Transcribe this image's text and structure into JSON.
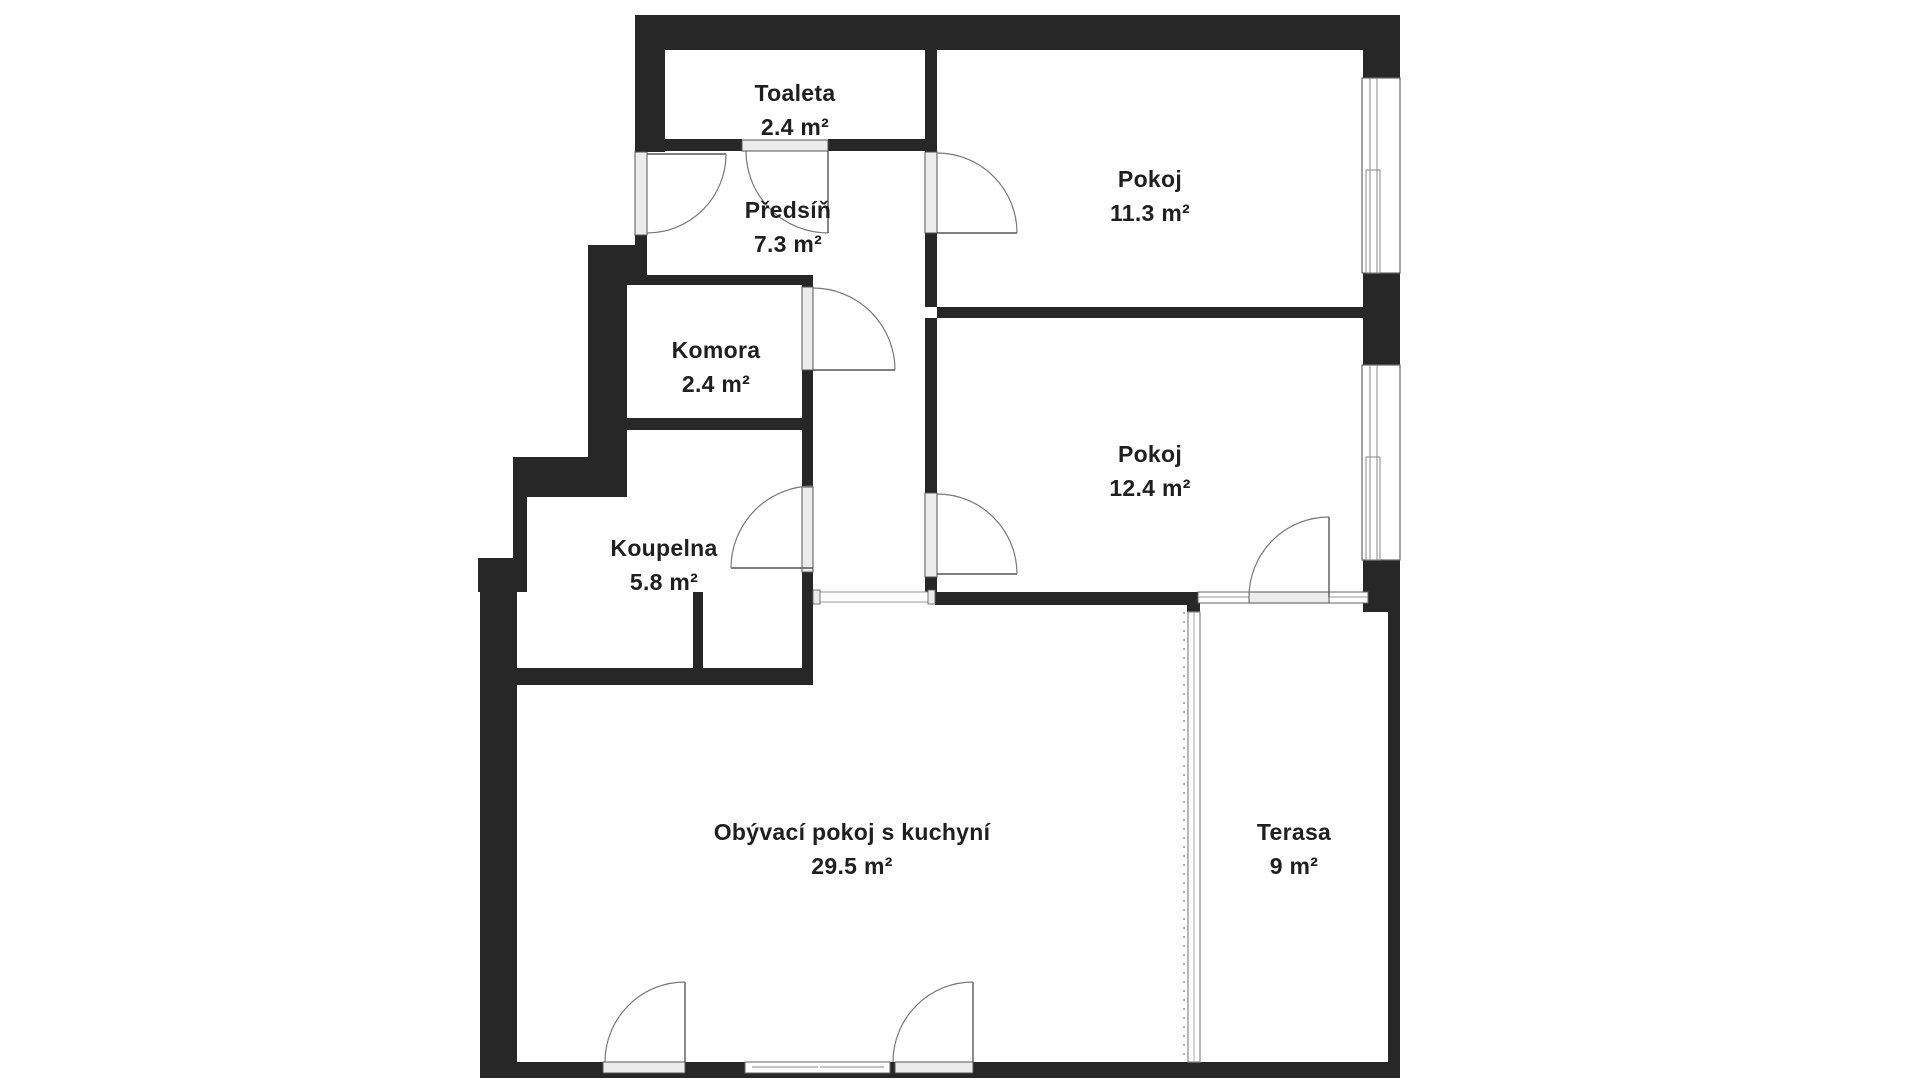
{
  "plan": {
    "rooms": [
      {
        "id": "toaleta",
        "name": "Toaleta",
        "area": "2.4 m²"
      },
      {
        "id": "predsin",
        "name": "Předsíň",
        "area": "7.3 m²"
      },
      {
        "id": "pokoj-1",
        "name": "Pokoj",
        "area": "11.3 m²"
      },
      {
        "id": "komora",
        "name": "Komora",
        "area": "2.4 m²"
      },
      {
        "id": "pokoj-2",
        "name": "Pokoj",
        "area": "12.4 m²"
      },
      {
        "id": "koupelna",
        "name": "Koupelna",
        "area": "5.8 m²"
      },
      {
        "id": "obyvaci",
        "name": "Obývací pokoj s kuchyní",
        "area": "29.5 m²"
      },
      {
        "id": "terasa",
        "name": "Terasa",
        "area": "9 m²"
      }
    ],
    "colors": {
      "wall": "#272727",
      "door_fill": "#ececec",
      "line": "#777777",
      "text": "#1f1f1f"
    }
  }
}
